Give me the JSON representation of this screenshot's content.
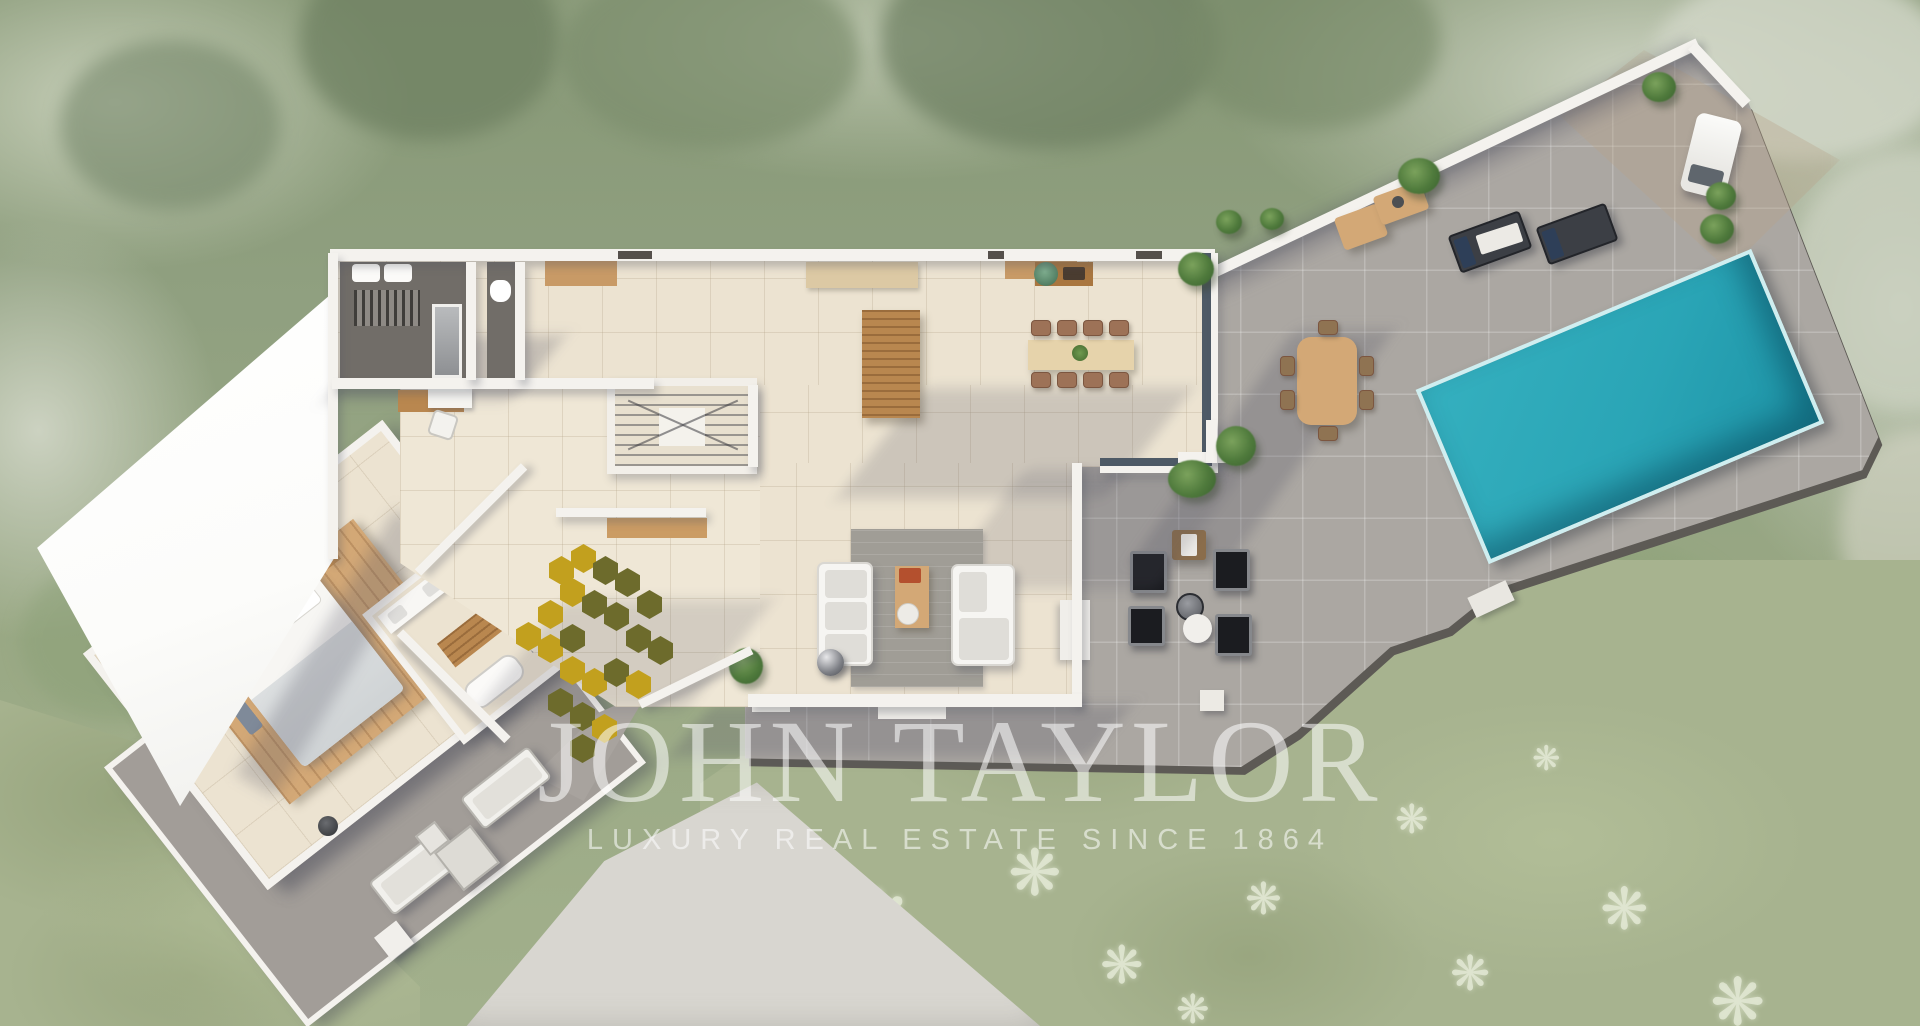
{
  "watermark": {
    "title": "JOHN TAYLOR",
    "subtitle": "LUXURY REAL ESTATE SINCE 1864"
  },
  "garden": {
    "agave_glyph": "❋"
  },
  "palette": {
    "foliage": "#8d9b7c",
    "lawn": "#a7b38f",
    "deck": "#aba7a2",
    "deck_light": "#b6b2ac",
    "terrace_gray": "#a29d98",
    "drive": "#d8d6d0",
    "wall_white": "#f4f2ee",
    "white_roof": "#fcfcfa",
    "floor_cream": "#ece3d1",
    "dark_room": "#716d68",
    "glass": "#4e5a66",
    "wood": "#b9874f",
    "wood_light": "#d3a876",
    "rust_chair": "#9d7257",
    "hex_yellow": "#c2a01e",
    "hex_olive": "#6d6b2c",
    "pool_water": "#35b0bf",
    "pool_deep": "#1d93a6",
    "pool_edge": "#cfeef0",
    "watermark": "rgba(255,255,255,0.55)"
  }
}
